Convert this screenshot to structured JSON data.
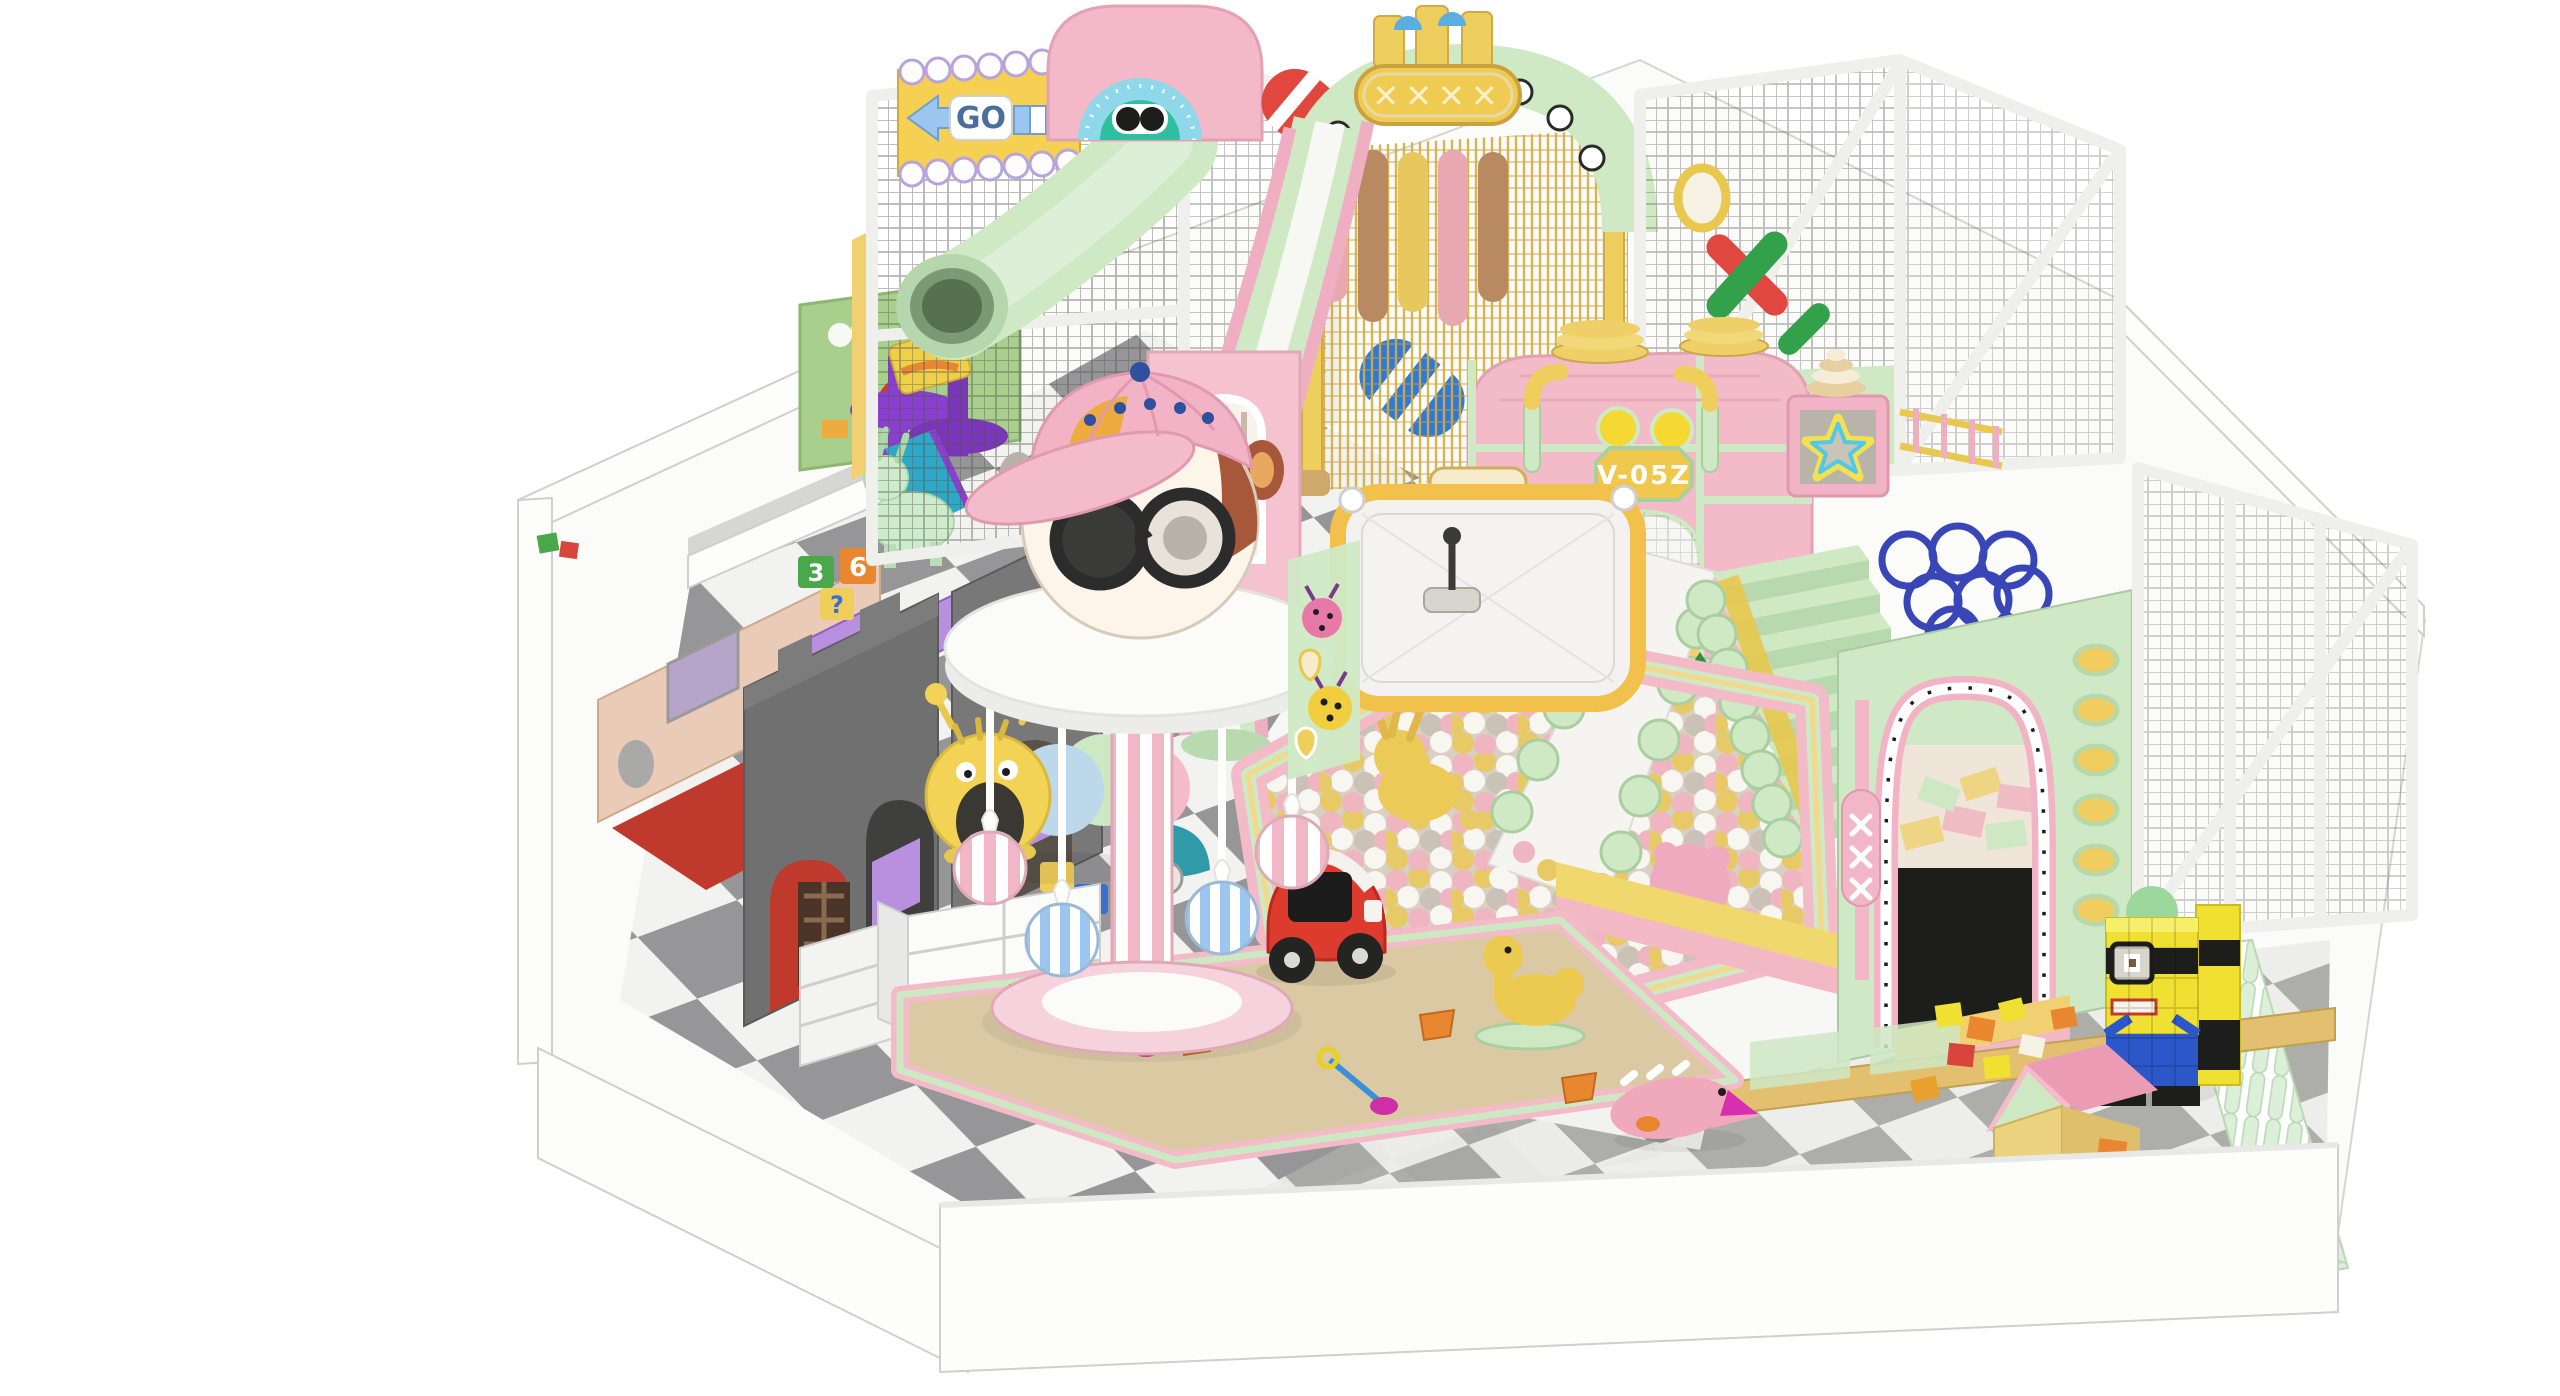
{
  "scene": {
    "kind": "3d-render",
    "subject": "pastel indoor children soft-play playground",
    "background": "#ffffff"
  },
  "signs": {
    "go_sign": {
      "text": "GO",
      "panel": "#f5d052",
      "trim": "#b7a4dd",
      "arrow": "#9cc6f0",
      "text_color": "#4a6f9f"
    },
    "gate_plaque": {
      "text": "✕✕✕✕",
      "panel": "#f0cb52",
      "text_color": "#faf0cc"
    },
    "castle_plaque": {
      "text": "V-05Z",
      "panel": "#f0c84e",
      "text_color": "#ffffff"
    },
    "activity_board": {
      "glyph": "?",
      "board": "#a9cf8d",
      "glyph_color": "#d8352f"
    }
  },
  "toy_blocks": {
    "labels": {
      "question": "?",
      "six": "6",
      "three": "3"
    }
  },
  "counts": {
    "portholes": 6,
    "hanging_rings": 7,
    "gate_dots": 8,
    "stair_steps": 8
  },
  "ball_pit": {
    "colors": {
      "pink": "#efb5c1",
      "yellow": "#e7ca66",
      "white": "#f8f6f0",
      "beige": "#cac2b6"
    }
  },
  "palette": {
    "wall": "#fdfdfc",
    "wall_edge": "#cfcfcd",
    "wall_shade": "#ececea",
    "tile_dark": "#919193",
    "tile_light": "#f2f2ef",
    "mat_dark": "#a9a9a6",
    "mat_light": "#ececea",
    "mesh": "#55534f",
    "gold": "#d4ad3f",
    "pink": "#f3bac8",
    "pink_deep": "#eb9cb4",
    "mint": "#cfe9c5",
    "mint_deep": "#a9cfa0",
    "yellow": "#f0ce5c",
    "yellow_deep": "#e0b34a",
    "cream": "#f6eccb",
    "lavender": "#b7a4dd",
    "blue": "#9cc6f0",
    "navy": "#3a4f8f",
    "teal_face": "#2fbfa0",
    "sky": "#8fd8ea",
    "red": "#e0473f",
    "green": "#33a04a",
    "blue_roller": "#3079d8",
    "ring_blue": "#3946b8",
    "purple": "#8a3fd1",
    "violet": "#b98fe0",
    "tan": "#e9cbb8",
    "facade_gray": "#707070",
    "red_floor": "#bf3a2c",
    "sand": "#dbc9a4",
    "orange": "#e8872f",
    "magenta": "#cf2fa6",
    "teal_car": "#2f9aa8",
    "red_car": "#dd3b2d",
    "black": "#1d1d1b",
    "minion_yellow": "#efe032",
    "minion_blue": "#2b57c8",
    "wood": "#e2c070",
    "fence": "#dcefd8",
    "screen_frame": "#f1c14b",
    "screen_face": "#f3f2f0",
    "hamster_brown": "#a8583a",
    "face_cream": "#fdf4ea",
    "cap_pink": "#f2b3c6",
    "cap_orange": "#efac3e",
    "duck": "#ecc94f",
    "dino": "#f0a8bc",
    "caterpillar_yellow": "#f2d355",
    "slide_white": "#f5f4f1",
    "board_green": "#a9cf8d"
  }
}
